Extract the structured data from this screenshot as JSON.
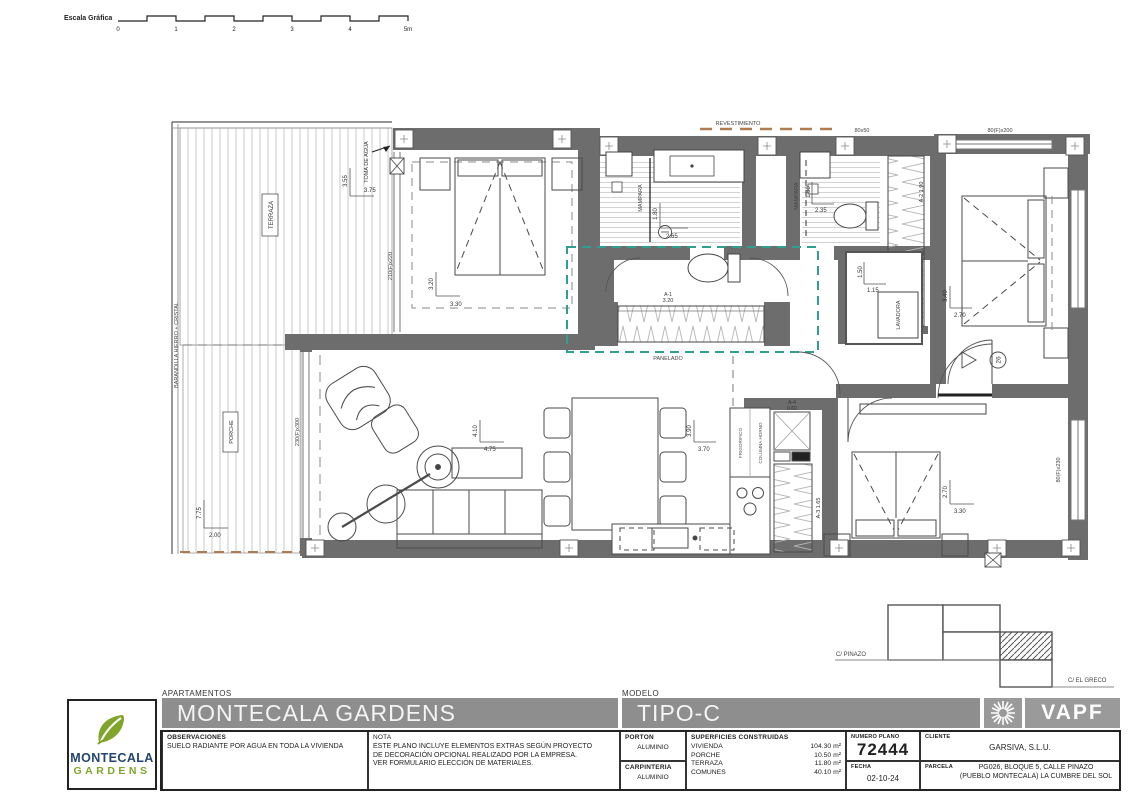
{
  "scalebar": {
    "label": "Escala Gráfica",
    "ticks": [
      "0",
      "1",
      "2",
      "3",
      "4",
      "5m"
    ]
  },
  "plan": {
    "terraza": "TERRAZA",
    "porche": "PORCHE",
    "barandilla": "BARANDILLA HIERRO + CRISTAL",
    "toma_de_agua": "TOMA DE AGUA",
    "revestimiento": "REVESTIMIENTO",
    "panelado": "PANELADO",
    "mampara": "MAMPARA",
    "lavadora": "LAVADORA",
    "frigorifico": "FRIGORIFICO",
    "columna_horno": "COLUMNA HORNO",
    "door_number": "26",
    "windows": {
      "master": "210(F)x220",
      "living": "230(F)x300",
      "small": "80x50",
      "bed2": "80(F)x200",
      "bed3": "80(F)x230"
    },
    "wardrobes": {
      "a1_code": "A-1",
      "a1_size": "3.20",
      "a2": "A-2  1.90",
      "a3": "A-3  1.65",
      "a4_code": "A-4",
      "a4_size": "0.60"
    },
    "dims": {
      "terraza_v": "3.55",
      "terraza_h": "3.75",
      "porche_v": "7.75",
      "porche_h": "2.00",
      "master_v": "3.20",
      "master_h": "3.30",
      "bath1_v": "1.80",
      "bath1_h": "2.65",
      "bath2_v": "1.80",
      "bath2_h": "2.35",
      "laundry_v": "1.50",
      "laundry_h": "1.15",
      "bed2_v": "3.40",
      "bed2_h": "2.70",
      "living_v": "4.10",
      "living_h": "4.75",
      "dining_v": "3.90",
      "dining_h": "3.70",
      "bed3_v": "2.70",
      "bed3_h": "3.30"
    }
  },
  "siteplan": {
    "street_left": "C/ PINAZO",
    "street_right": "C/ EL GRECO"
  },
  "logo": {
    "line1": "MONTECALA",
    "line2": "GARDENS"
  },
  "brand": {
    "name": "VAPF"
  },
  "titleblock": {
    "apartamentos_label": "APARTAMENTOS",
    "project_title": "MONTECALA GARDENS",
    "modelo_label": "MODELO",
    "model_title": "TIPO-C",
    "observaciones_label": "OBSERVACIONES",
    "observaciones_text": "SUELO RADIANTE POR AGUA EN TODA LA VIVIENDA",
    "nota_label": "NOTA",
    "nota_lines": [
      "ESTE PLANO INCLUYE ELEMENTOS EXTRAS SEGÚN PROYECTO",
      "DE DECORACIÓN OPCIONAL REALIZADO POR LA EMPRESA.",
      "VER FORMULARIO ELECCIÓN DE MATERIALES."
    ],
    "porton_label": "PORTON",
    "porton_value": "ALUMINIO",
    "carpinteria_label": "CARPINTERIA",
    "carpinteria_value": "ALUMINIO",
    "superficies_label": "SUPERFICIES CONSTRUIDAS",
    "superficies": [
      {
        "name": "VIVIENDA",
        "value": "104.30 m²"
      },
      {
        "name": "PORCHE",
        "value": "10.50 m²"
      },
      {
        "name": "TERRAZA",
        "value": "11.80 m²"
      },
      {
        "name": "COMUNES",
        "value": "40.10 m²"
      }
    ],
    "numero_plano_label": "NUMERO PLANO",
    "numero_plano": "72444",
    "fecha_label": "FECHA",
    "fecha": "02-10-24",
    "cliente_label": "CLIENTE",
    "cliente": "GARSIVA, S.L.U.",
    "parcela_label": "PARCELA",
    "parcela_lines": [
      "PG026, BLOQUE 5, CALLE PINAZO",
      "(PUEBLO MONTECALA) LA CUMBRE DEL SOL"
    ]
  }
}
